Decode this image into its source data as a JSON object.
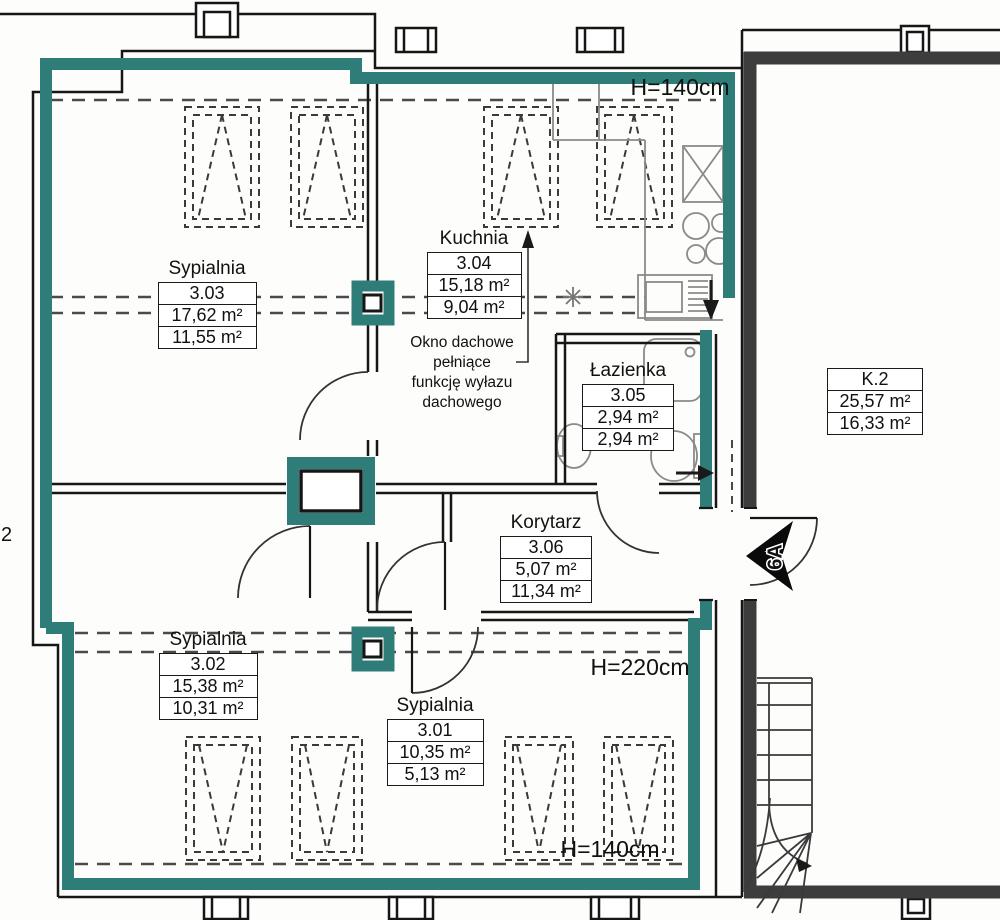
{
  "rooms": [
    {
      "name": "Sypialnia",
      "number": "3.03",
      "area": "17,62 m²",
      "reduced_area": "11,55 m²"
    },
    {
      "name": "Kuchnia",
      "number": "3.04",
      "area": "15,18 m²",
      "reduced_area": "9,04 m²"
    },
    {
      "name": "Łazienka",
      "number": "3.05",
      "area": "2,94 m²",
      "reduced_area": "2,94 m²"
    },
    {
      "name": "Korytarz",
      "number": "3.06",
      "area": "5,07 m²",
      "reduced_area": "11,34 m²"
    },
    {
      "name": "Sypialnia",
      "number": "3.02",
      "area": "15,38 m²",
      "reduced_area": "10,31 m²"
    },
    {
      "name": "Sypialnia",
      "number": "3.01",
      "area": "10,35 m²",
      "reduced_area": "5,13 m²"
    },
    {
      "name": "",
      "number": "K.2",
      "area": "25,57 m²",
      "reduced_area": "16,33 m²"
    }
  ],
  "annotations": {
    "height_top": "H=140cm",
    "height_mid": "H=220cm",
    "height_bottom": "H=140cm",
    "skylight_note_lines": [
      "Okno dachowe",
      "pełniące",
      "funkcję wyłazu",
      "dachowego"
    ],
    "entrance_door": "6A",
    "edge_label": "2"
  },
  "colors": {
    "apartment_wall_accent": "#2e7d79",
    "stairwell_wall": "#3d3d3d",
    "line": "#1a1a1a"
  }
}
